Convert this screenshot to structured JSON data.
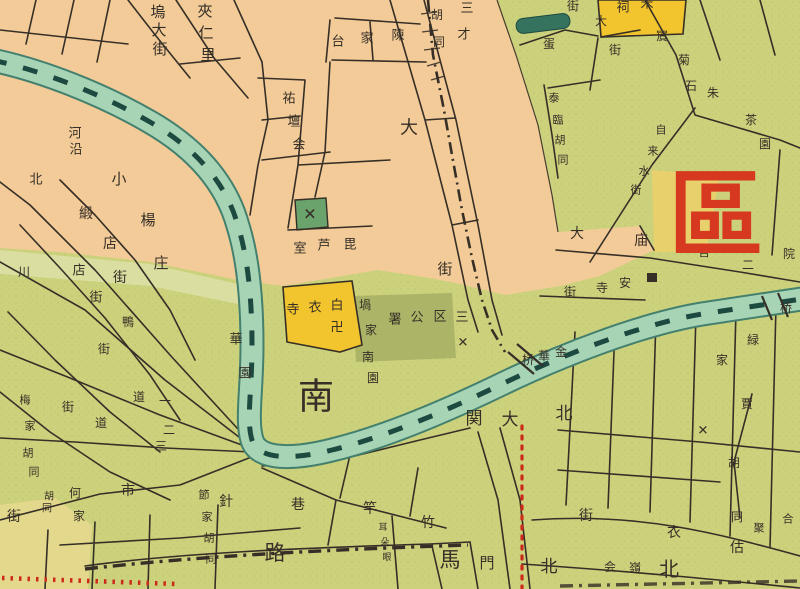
{
  "map": {
    "type": "historical-city-map",
    "district_mark": "區",
    "colors": {
      "paper": "#f3cb98",
      "green": "#ccd17c",
      "green_light": "#dfe3ad",
      "green_dark_block": "#a9b065",
      "green_x_block": "#6aa36c",
      "yellow_block": "#f2c42e",
      "yellow_tint": "#ecd16a",
      "pale_yellow": "#e6d98e",
      "river": "#a8d4b6",
      "river_edge": "#44806e",
      "river_dark": "#1d4a40",
      "pond": "#35735f",
      "ink": "#362f27",
      "route_red": "#cc2b1a",
      "big_red": "#d6391f"
    },
    "labels": [
      {
        "name": "street-wudajie",
        "text": "塢大街",
        "size": 15,
        "chars": [
          [
            158,
            12
          ],
          [
            159,
            30
          ],
          [
            160,
            49
          ]
        ]
      },
      {
        "name": "block-jiarenli",
        "text": "夾仁里",
        "size": 15,
        "chars": [
          [
            205,
            11
          ],
          [
            206,
            33
          ],
          [
            208,
            55
          ]
        ]
      },
      {
        "name": "street-heyan",
        "text": "河沿",
        "size": 13,
        "chars": [
          [
            75,
            134
          ],
          [
            76,
            150
          ]
        ]
      },
      {
        "name": "street-bei",
        "text": "北",
        "size": 13,
        "chars": [
          [
            36,
            180
          ]
        ]
      },
      {
        "name": "street-xiaoyangzhuang",
        "text": "小楊庄",
        "size": 15,
        "chars": [
          [
            119,
            179
          ],
          [
            148,
            220
          ],
          [
            161,
            263
          ]
        ]
      },
      {
        "name": "street-duandianjie",
        "text": "緞店街",
        "size": 14,
        "chars": [
          [
            86,
            214
          ],
          [
            110,
            244
          ],
          [
            120,
            278
          ]
        ]
      },
      {
        "name": "street-dianjie",
        "text": "店街",
        "size": 13,
        "chars": [
          [
            79,
            271
          ],
          [
            96,
            298
          ]
        ]
      },
      {
        "name": "street-chuan",
        "text": "川",
        "size": 12,
        "chars": [
          [
            24,
            272
          ]
        ]
      },
      {
        "name": "street-ya",
        "text": "鴨",
        "size": 12,
        "chars": [
          [
            128,
            322
          ]
        ]
      },
      {
        "name": "block-chenjiatai",
        "text": "陳家台",
        "size": 13,
        "chars": [
          [
            398,
            36
          ],
          [
            367,
            39
          ],
          [
            338,
            42
          ]
        ]
      },
      {
        "name": "street-hutong-top",
        "text": "胡同",
        "size": 12,
        "chars": [
          [
            437,
            15
          ],
          [
            439,
            42
          ]
        ]
      },
      {
        "name": "block-sancai",
        "text": "三才",
        "size": 13,
        "chars": [
          [
            467,
            9
          ],
          [
            464,
            35
          ]
        ]
      },
      {
        "name": "block-youtanhui",
        "text": "祐壇会",
        "size": 13,
        "chars": [
          [
            289,
            99
          ],
          [
            294,
            122
          ],
          [
            299,
            145
          ]
        ]
      },
      {
        "name": "street-da",
        "text": "大",
        "size": 18,
        "chars": [
          [
            409,
            128
          ]
        ]
      },
      {
        "name": "street-jie",
        "text": "街",
        "size": 15,
        "chars": [
          [
            445,
            269
          ]
        ]
      },
      {
        "name": "block-pilushi",
        "text": "毘芦室",
        "size": 13,
        "chars": [
          [
            350,
            245
          ],
          [
            324,
            246
          ],
          [
            300,
            249
          ]
        ]
      },
      {
        "name": "temple-baiyisi",
        "text": "白衣寺",
        "size": 13,
        "chars": [
          [
            337,
            306
          ],
          [
            315,
            308
          ],
          [
            293,
            310
          ]
        ]
      },
      {
        "name": "swastika-mark",
        "text": "卍",
        "size": 13,
        "chars": [
          [
            337,
            328
          ]
        ]
      },
      {
        "name": "block-guojia",
        "text": "堝家",
        "size": 12,
        "chars": [
          [
            365,
            305
          ],
          [
            371,
            330
          ]
        ]
      },
      {
        "name": "block-nanyuan",
        "text": "南園",
        "size": 12,
        "chars": [
          [
            368,
            357
          ],
          [
            373,
            378
          ]
        ]
      },
      {
        "name": "office-district3",
        "text": "三区公署",
        "size": 13,
        "chars": [
          [
            462,
            318
          ],
          [
            440,
            317
          ],
          [
            417,
            318
          ],
          [
            395,
            320
          ]
        ]
      },
      {
        "name": "block-huayuan",
        "text": "華園",
        "size": 13,
        "chars": [
          [
            236,
            340
          ],
          [
            245,
            374
          ]
        ]
      },
      {
        "name": "big-nan",
        "text": "南",
        "size": 36,
        "chars": [
          [
            316,
            397
          ]
        ]
      },
      {
        "name": "place-beidaguan",
        "text": "北大関",
        "size": 17,
        "chars": [
          [
            564,
            414
          ],
          [
            510,
            420
          ],
          [
            474,
            419
          ]
        ]
      },
      {
        "name": "bridge-jinhuaqiao",
        "text": "金華桥",
        "size": 12,
        "chars": [
          [
            561,
            352
          ],
          [
            544,
            356
          ],
          [
            528,
            360
          ]
        ]
      },
      {
        "name": "big-lu",
        "text": "路",
        "size": 21,
        "chars": [
          [
            275,
            553
          ]
        ]
      },
      {
        "name": "big-ma",
        "text": "馬",
        "size": 21,
        "chars": [
          [
            450,
            560
          ]
        ]
      },
      {
        "name": "gate-men",
        "text": "門",
        "size": 15,
        "chars": [
          [
            487,
            563
          ]
        ]
      },
      {
        "name": "gate-bei",
        "text": "北",
        "size": 17,
        "chars": [
          [
            549,
            567
          ]
        ]
      },
      {
        "name": "big-bei",
        "text": "北",
        "size": 20,
        "chars": [
          [
            669,
            569
          ]
        ]
      },
      {
        "name": "street-zhuganxiang",
        "text": "竹竿巷",
        "size": 14,
        "chars": [
          [
            428,
            523
          ],
          [
            370,
            509
          ],
          [
            298,
            505
          ]
        ]
      },
      {
        "name": "street-zhenshijie",
        "text": "針市街",
        "size": 14,
        "chars": [
          [
            226,
            502
          ],
          [
            128,
            491
          ],
          [
            14,
            517
          ]
        ]
      },
      {
        "name": "street-hejia",
        "text": "何家",
        "size": 12,
        "chars": [
          [
            75,
            493
          ],
          [
            79,
            516
          ]
        ]
      },
      {
        "name": "street-hutong-left",
        "text": "胡同",
        "size": 10,
        "chars": [
          [
            49,
            497
          ],
          [
            47,
            509
          ]
        ]
      },
      {
        "name": "street-jiejiahutong",
        "text": "節家胡同",
        "size": 11,
        "chars": [
          [
            204,
            495
          ],
          [
            207,
            517
          ],
          [
            209,
            538
          ],
          [
            211,
            559
          ]
        ]
      },
      {
        "name": "street-meijiahutong",
        "text": "梅家胡同",
        "size": 11,
        "chars": [
          [
            25,
            400
          ],
          [
            30,
            426
          ],
          [
            28,
            453
          ],
          [
            34,
            472
          ]
        ]
      },
      {
        "name": "street-jie-a",
        "text": "街",
        "size": 12,
        "chars": [
          [
            104,
            349
          ]
        ]
      },
      {
        "name": "street-dao-a",
        "text": "道",
        "size": 12,
        "chars": [
          [
            139,
            397
          ]
        ]
      },
      {
        "name": "street-yi",
        "text": "一",
        "size": 12,
        "chars": [
          [
            165,
            401
          ]
        ]
      },
      {
        "name": "street-dao-b",
        "text": "道",
        "size": 12,
        "chars": [
          [
            101,
            423
          ]
        ]
      },
      {
        "name": "street-er",
        "text": "二",
        "size": 12,
        "chars": [
          [
            169,
            430
          ]
        ]
      },
      {
        "name": "street-san",
        "text": "三",
        "size": 12,
        "chars": [
          [
            161,
            446
          ]
        ]
      },
      {
        "name": "street-jie-b",
        "text": "街",
        "size": 12,
        "chars": [
          [
            68,
            407
          ]
        ]
      },
      {
        "name": "alley-tiny",
        "text": "耳朵眼",
        "size": 9,
        "chars": [
          [
            383,
            528
          ],
          [
            385,
            543
          ],
          [
            387,
            558
          ]
        ]
      },
      {
        "name": "street-guyijie",
        "text": "估衣街",
        "size": 14,
        "chars": [
          [
            737,
            548
          ],
          [
            674,
            533
          ],
          [
            586,
            516
          ]
        ]
      },
      {
        "name": "block-linghui",
        "text": "嶺会",
        "size": 12,
        "chars": [
          [
            635,
            568
          ],
          [
            610,
            567
          ]
        ]
      },
      {
        "name": "block-lujia",
        "text": "緑家",
        "size": 12,
        "chars": [
          [
            753,
            340
          ],
          [
            722,
            360
          ]
        ]
      },
      {
        "name": "street-jiahutong",
        "text": "賈胡同",
        "size": 12,
        "chars": [
          [
            747,
            404
          ],
          [
            734,
            463
          ],
          [
            737,
            517
          ]
        ]
      },
      {
        "name": "block-heju",
        "text": "合聚",
        "size": 11,
        "chars": [
          [
            788,
            519
          ],
          [
            759,
            528
          ]
        ]
      },
      {
        "name": "place-damiao",
        "text": "大庙",
        "size": 14,
        "chars": [
          [
            577,
            234
          ],
          [
            641,
            241
          ]
        ]
      },
      {
        "name": "label-guan",
        "text": "官",
        "size": 12,
        "chars": [
          [
            704,
            252
          ]
        ]
      },
      {
        "name": "label-er2",
        "text": "二",
        "size": 12,
        "chars": [
          [
            748,
            265
          ]
        ]
      },
      {
        "name": "label-yuan",
        "text": "院",
        "size": 12,
        "chars": [
          [
            789,
            254
          ]
        ]
      },
      {
        "name": "street-ansijie",
        "text": "安寺街",
        "size": 12,
        "chars": [
          [
            625,
            283
          ],
          [
            602,
            288
          ],
          [
            570,
            292
          ]
        ]
      },
      {
        "name": "bridge-east",
        "text": "桥",
        "size": 12,
        "chars": [
          [
            786,
            308
          ]
        ]
      },
      {
        "name": "street-tailinhutong",
        "text": "泰臨胡同",
        "size": 11,
        "chars": [
          [
            554,
            98
          ],
          [
            558,
            120
          ],
          [
            560,
            140
          ],
          [
            563,
            160
          ]
        ]
      },
      {
        "name": "street-zilaishuijie",
        "text": "自来水街",
        "size": 11,
        "chars": [
          [
            661,
            130
          ],
          [
            653,
            151
          ],
          [
            644,
            171
          ],
          [
            636,
            190
          ]
        ]
      },
      {
        "name": "street-binjushi",
        "text": "賔菊石",
        "size": 12,
        "chars": [
          [
            662,
            36
          ],
          [
            684,
            60
          ],
          [
            691,
            86
          ]
        ]
      },
      {
        "name": "street-jie-ne",
        "text": "街",
        "size": 12,
        "chars": [
          [
            573,
            6
          ]
        ]
      },
      {
        "name": "label-dan",
        "text": "蛋",
        "size": 12,
        "chars": [
          [
            549,
            44
          ]
        ]
      },
      {
        "name": "street-dajie-ne",
        "text": "大街",
        "size": 12,
        "chars": [
          [
            601,
            21
          ],
          [
            615,
            50
          ]
        ]
      },
      {
        "name": "temple-ci",
        "text": "祠",
        "size": 13,
        "chars": [
          [
            623,
            8
          ]
        ]
      },
      {
        "name": "temple-song",
        "text": "宋",
        "size": 13,
        "chars": [
          [
            647,
            4
          ]
        ]
      },
      {
        "name": "label-zhu",
        "text": "朱",
        "size": 12,
        "chars": [
          [
            713,
            93
          ]
        ]
      },
      {
        "name": "block-chayuan",
        "text": "茶園",
        "size": 12,
        "chars": [
          [
            751,
            120
          ],
          [
            765,
            144
          ]
        ]
      },
      {
        "name": "district-qu",
        "text": "區",
        "size": 95,
        "bold": true,
        "color": "#d6391f",
        "chars": [
          [
            716,
            216
          ]
        ]
      },
      {
        "name": "x-mark-green",
        "text": "✕",
        "size": 16,
        "chars": [
          [
            310,
            214
          ]
        ]
      },
      {
        "name": "x-mark-mid",
        "text": "✕",
        "size": 13,
        "chars": [
          [
            463,
            343
          ]
        ]
      },
      {
        "name": "x-mark-right",
        "text": "✕",
        "size": 13,
        "chars": [
          [
            703,
            431
          ]
        ]
      }
    ]
  }
}
